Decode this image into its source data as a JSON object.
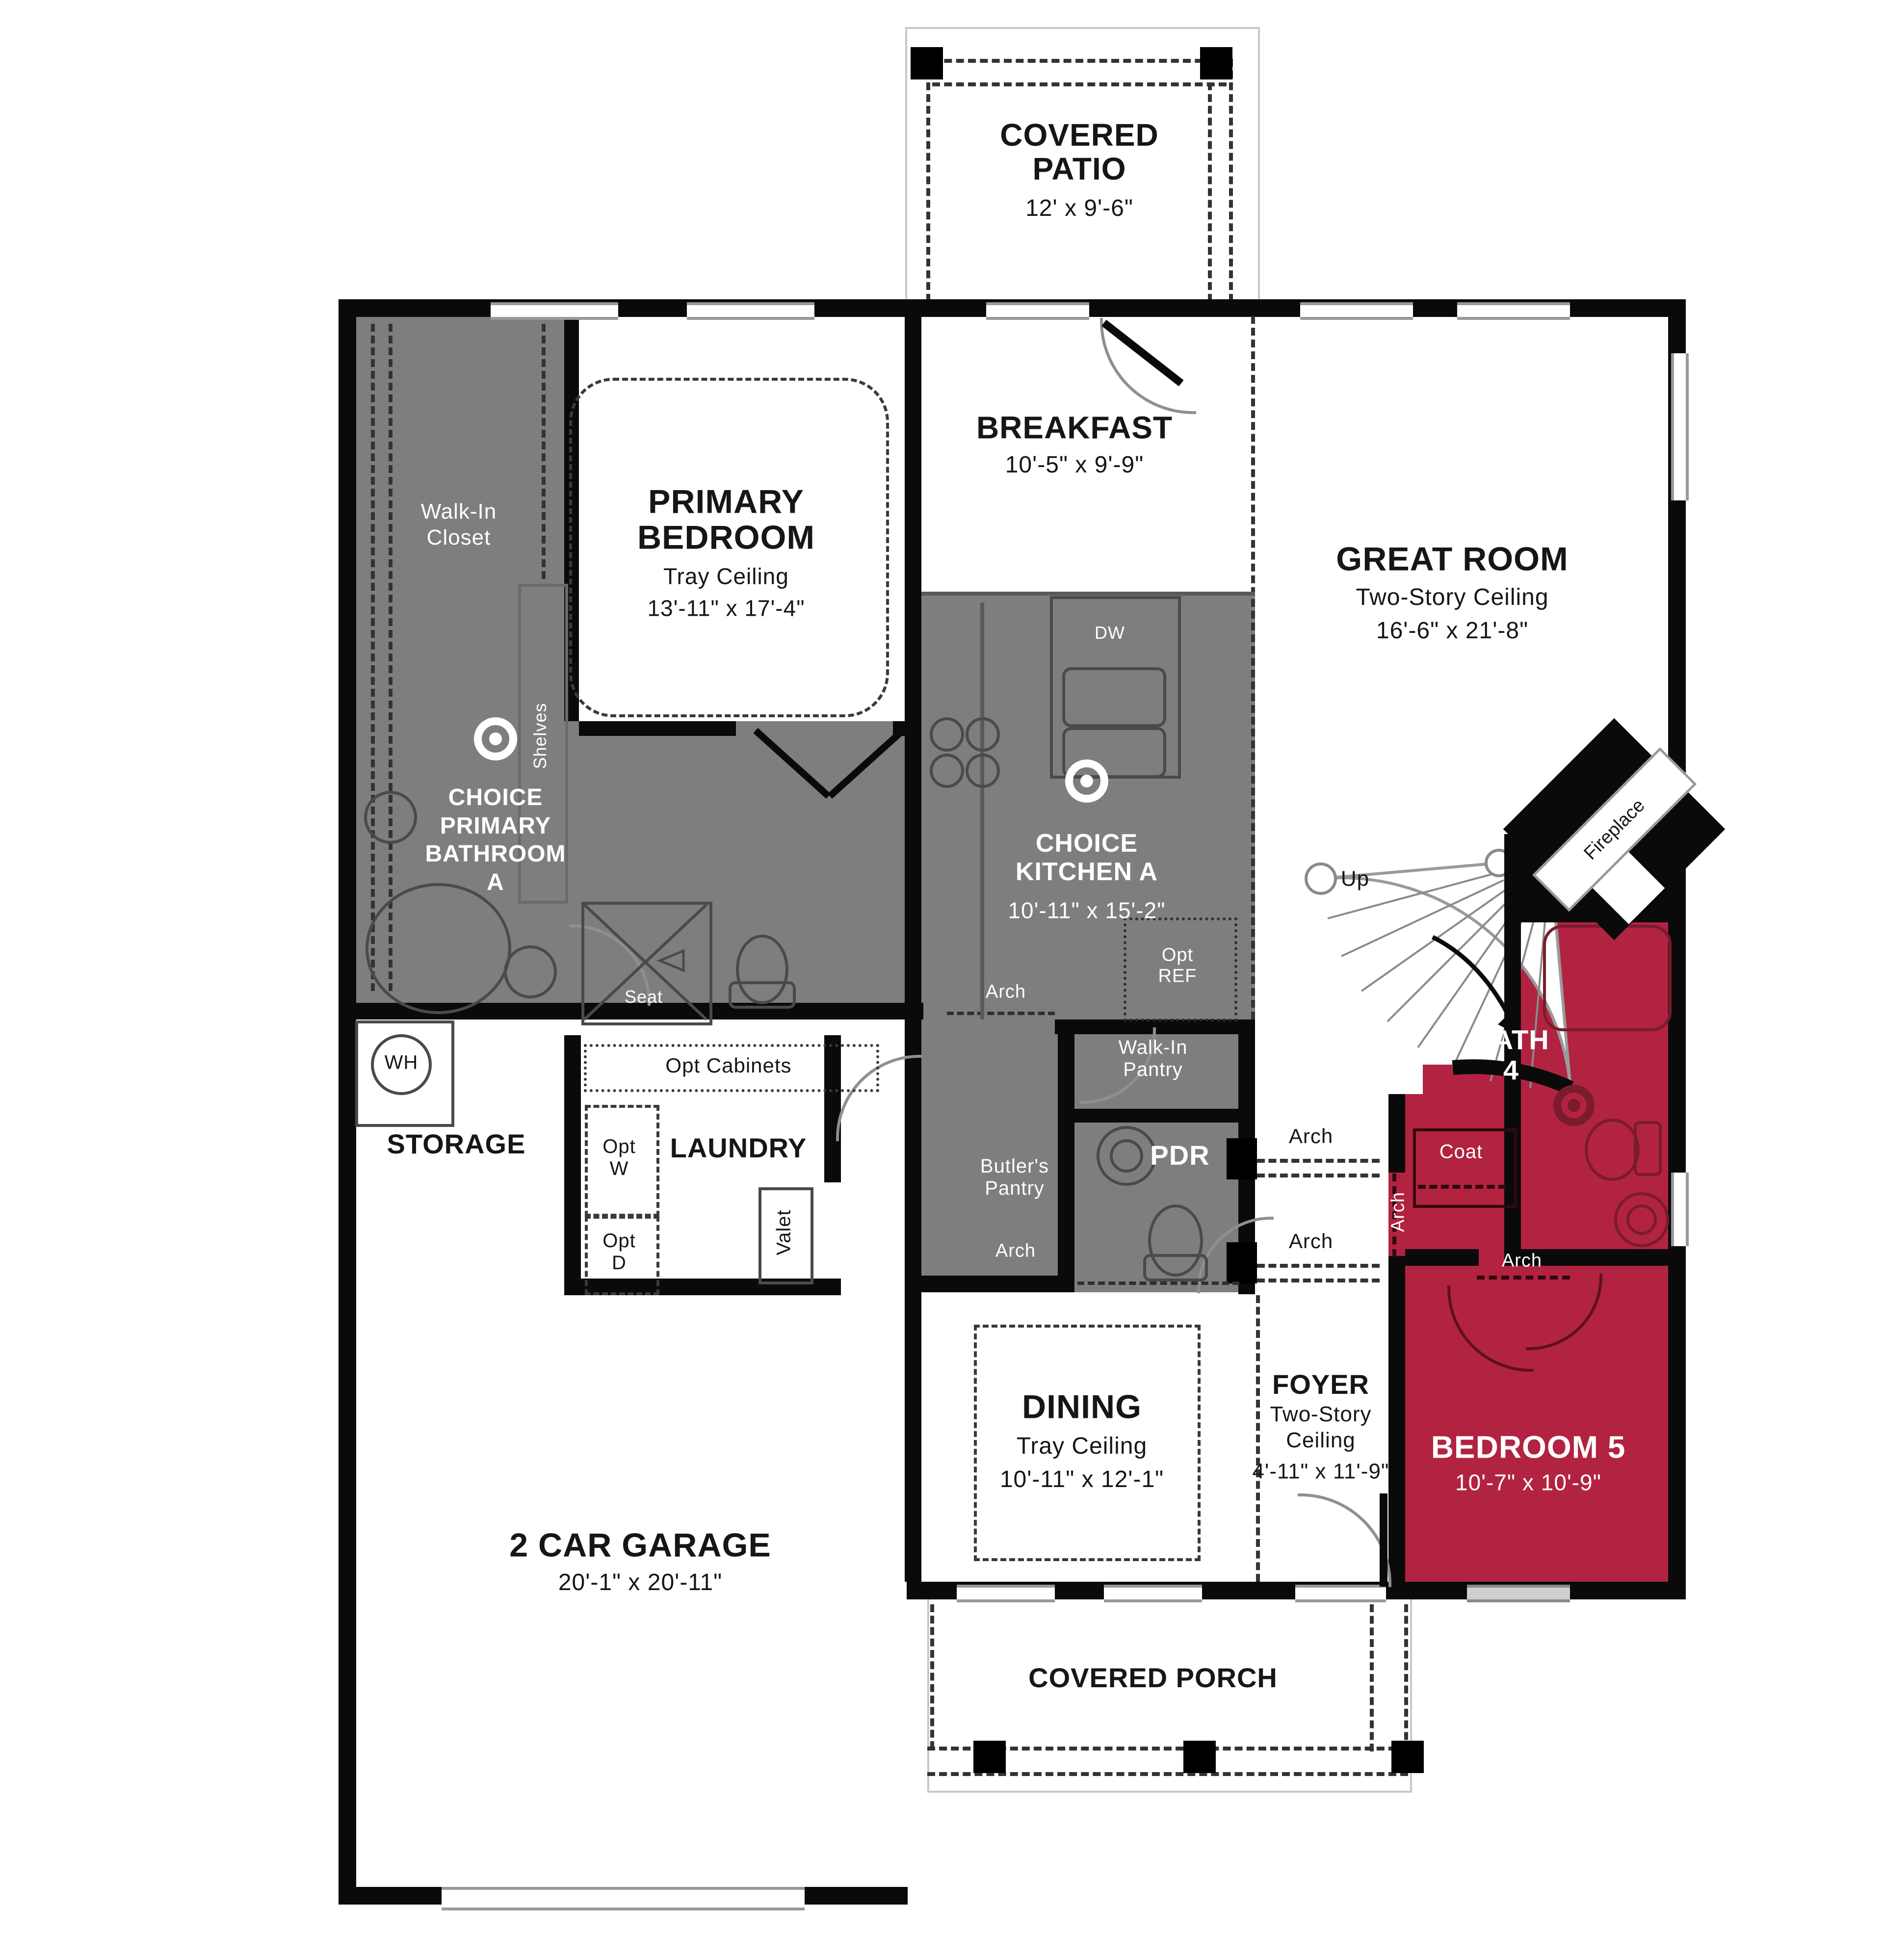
{
  "plan": {
    "colors": {
      "accent_red": "#b22341",
      "room_gray": "#7e7e7e",
      "wall_black": "#0a0a0a"
    },
    "rooms": {
      "covered_patio": {
        "name": "COVERED\nPATIO",
        "dims": "12' x 9'-6\""
      },
      "breakfast": {
        "name": "BREAKFAST",
        "dims": "10'-5\" x 9'-9\""
      },
      "great_room": {
        "name": "GREAT ROOM",
        "ceiling": "Two-Story Ceiling",
        "dims": "16'-6\" x 21'-8\""
      },
      "primary_bedroom": {
        "name": "PRIMARY\nBEDROOM",
        "ceiling": "Tray Ceiling",
        "dims": "13'-11\" x 17'-4\""
      },
      "walk_in_closet": {
        "name": "Walk-In\nCloset"
      },
      "primary_bathroom": {
        "name": "CHOICE\nPRIMARY\nBATHROOM\nA"
      },
      "kitchen": {
        "name": "CHOICE\nKITCHEN A",
        "dims": "10'-11\" x 15'-2\""
      },
      "storage": {
        "name": "STORAGE"
      },
      "laundry": {
        "name": "LAUNDRY"
      },
      "walk_in_pantry": {
        "name": "Walk-In\nPantry"
      },
      "butlers_pantry": {
        "name": "Butler's\nPantry"
      },
      "pdr": {
        "name": "PDR"
      },
      "dining": {
        "name": "DINING",
        "ceiling": "Tray Ceiling",
        "dims": "10'-11\" x 12'-1\""
      },
      "foyer": {
        "name": "FOYER",
        "ceiling": "Two-Story\nCeiling",
        "dims": "4'-11\" x 11'-9\""
      },
      "bath4": {
        "name": "BATH\n4"
      },
      "bedroom5": {
        "name": "BEDROOM 5",
        "dims": "10'-7\" x 10'-9\""
      },
      "garage": {
        "name": "2 CAR GARAGE",
        "dims": "20'-1\" x 20'-11\""
      },
      "covered_porch": {
        "name": "COVERED PORCH"
      },
      "coat": {
        "name": "Coat"
      }
    },
    "annotations": {
      "up": "Up",
      "fireplace": "Fireplace",
      "dw": "DW",
      "opt_ref": "Opt\nREF",
      "opt_cabinets": "Opt Cabinets",
      "opt_w": "Opt\nW",
      "opt_d": "Opt\nD",
      "valet": "Valet",
      "seat": "Seat",
      "shelves": "Shelves",
      "wh": "WH",
      "arch": "Arch"
    }
  }
}
